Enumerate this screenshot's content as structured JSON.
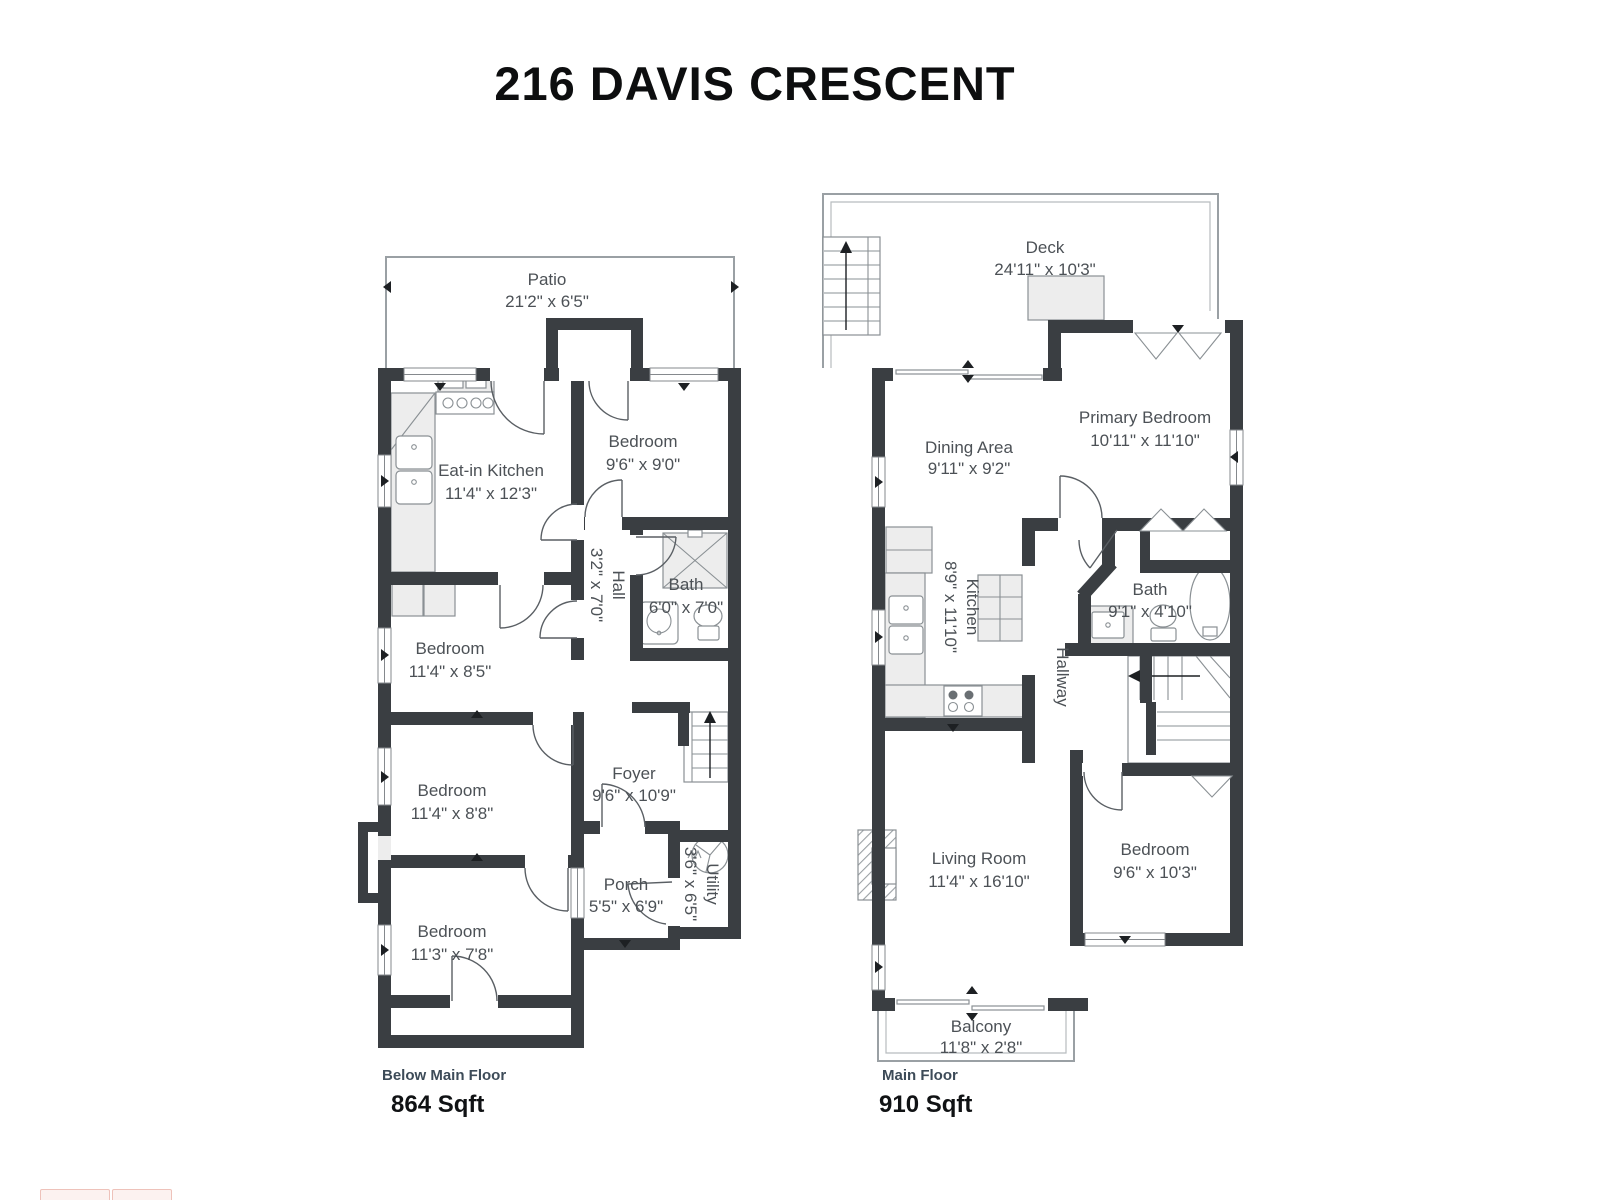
{
  "title": "216 DAVIS CRESCENT",
  "colors": {
    "wall": "#3a3e42",
    "room_label_text": "#4c5156",
    "floor_name_text": "#3d4b58",
    "sqft_text": "#101214",
    "thin_outline": "#9aa0a4",
    "fixture_fill": "#ededed",
    "fixture_stroke": "#8a9094"
  },
  "plans": [
    {
      "name": "Below Main Floor",
      "sqft": "864 Sqft",
      "rooms": [
        {
          "label": "Patio",
          "dims": "21'2\" x 6'5\""
        },
        {
          "label": "Eat-in Kitchen",
          "dims": "11'4\" x 12'3\""
        },
        {
          "label": "Bedroom",
          "dims": "9'6\" x 9'0\""
        },
        {
          "label": "Hall",
          "dims": "3'2\" x 7'0\""
        },
        {
          "label": "Bath",
          "dims": "6'0\" x 7'0\""
        },
        {
          "label": "Bedroom",
          "dims": "11'4\" x 8'5\""
        },
        {
          "label": "Bedroom",
          "dims": "11'4\" x 8'8\""
        },
        {
          "label": "Foyer",
          "dims": "9'6\" x 10'9\""
        },
        {
          "label": "Bedroom",
          "dims": "11'3\" x 7'8\""
        },
        {
          "label": "Porch",
          "dims": "5'5\" x 6'9\""
        },
        {
          "label": "Utility",
          "dims": "3'6\" x 6'5\""
        }
      ]
    },
    {
      "name": "Main Floor",
      "sqft": "910 Sqft",
      "rooms": [
        {
          "label": "Deck",
          "dims": "24'11\" x 10'3\""
        },
        {
          "label": "Dining Area",
          "dims": "9'11\" x 9'2\""
        },
        {
          "label": "Primary Bedroom",
          "dims": "10'11\" x 11'10\""
        },
        {
          "label": "Kitchen",
          "dims": "8'9\" x 11'10\""
        },
        {
          "label": "Bath",
          "dims": "9'1\" x 4'10\""
        },
        {
          "label": "Hallway",
          "dims": ""
        },
        {
          "label": "Living Room",
          "dims": "11'4\" x 16'10\""
        },
        {
          "label": "Bedroom",
          "dims": "9'6\" x 10'3\""
        },
        {
          "label": "Balcony",
          "dims": "11'8\" x 2'8\""
        }
      ]
    }
  ]
}
